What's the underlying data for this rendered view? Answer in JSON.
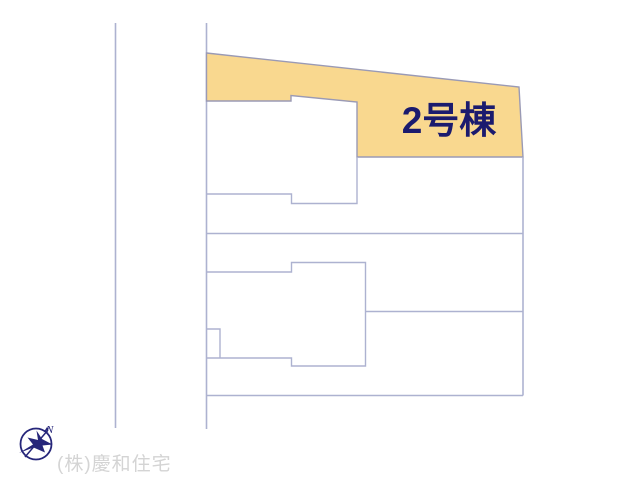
{
  "site_plan": {
    "lot_label": "2号棟",
    "colors": {
      "lot_highlight_fill": "#F9D88F",
      "boundary_line": "#ADB2D0",
      "plot_outline": "#9A9AB5",
      "lot_label_text": "#1B1B6E"
    }
  },
  "compass": {
    "icon": "north-compass-icon",
    "north_label": "N",
    "color": "#26267A"
  },
  "footer": {
    "company_name": "(株)慶和住宅",
    "text_color": "#D4D4D4"
  }
}
